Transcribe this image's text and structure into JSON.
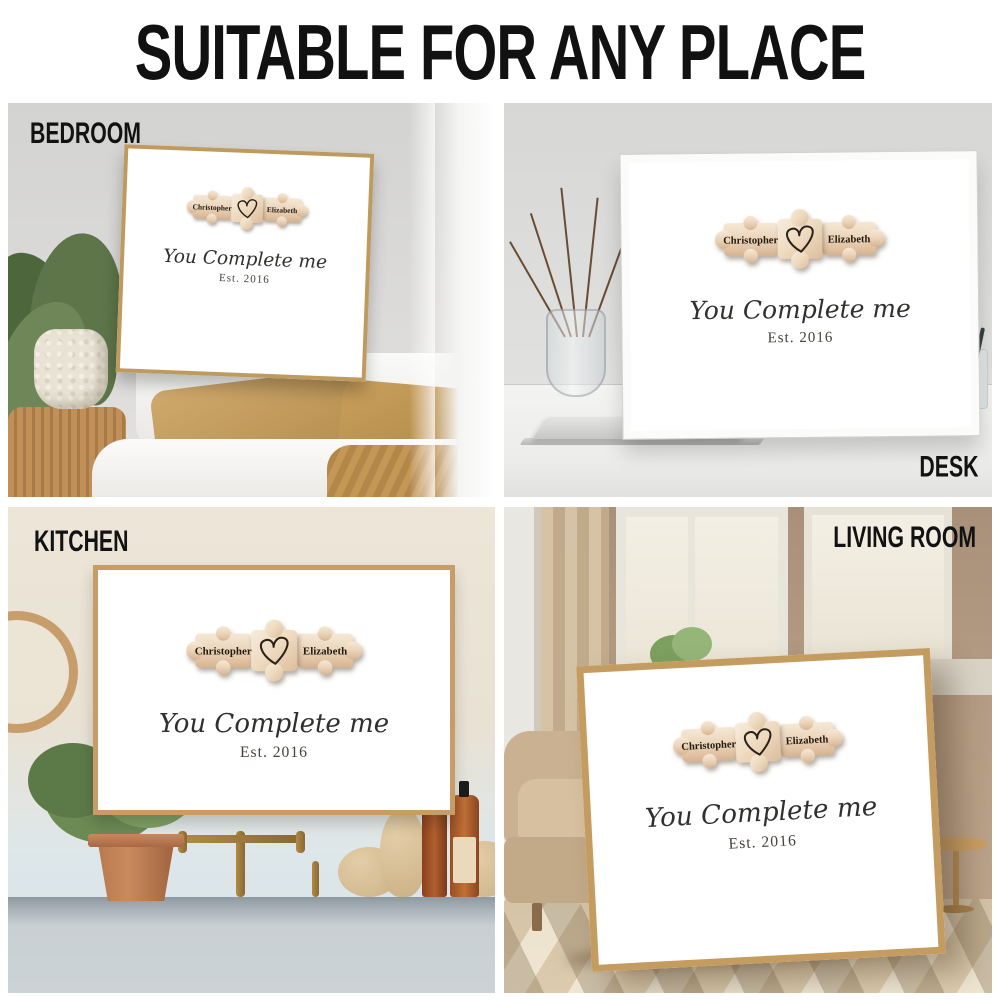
{
  "header": {
    "title": "SUITABLE FOR ANY PLACE"
  },
  "poster": {
    "name_left": "Christopher",
    "name_right": "Elizabeth",
    "tagline": "You Complete me",
    "established": "Est. 2016",
    "heart_icon": "hand-drawn-heart-outline",
    "puzzle_pieces_count": 3
  },
  "scenes": {
    "bedroom": {
      "label": "BEDROOM"
    },
    "desk": {
      "label": "DESK"
    },
    "kitchen": {
      "label": "KITCHEN"
    },
    "living_room": {
      "label": "LIVING ROOM"
    }
  },
  "colors": {
    "title_text": "#111111",
    "room_label_text": "#121212",
    "poster_background": "#ffffff",
    "puzzle_wood_light": "#f3e5d2",
    "puzzle_wood_dark": "#ddbf9f",
    "heart_stroke": "#2b2117",
    "frame_gold": "#bf9a5e",
    "frame_white": "#fbfbfa",
    "frame_oak": "#c89c66"
  }
}
